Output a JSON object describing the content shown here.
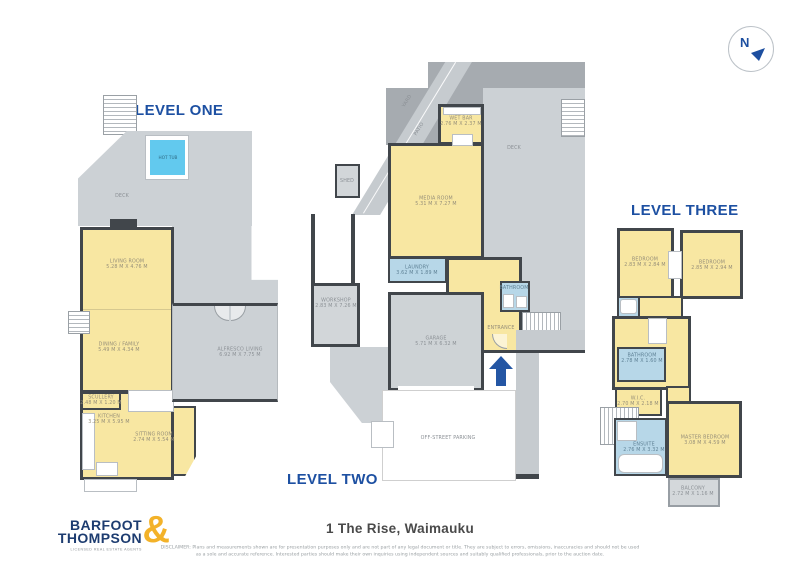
{
  "compass": {
    "label": "N"
  },
  "level_one": {
    "title": "LEVEL ONE",
    "rooms": {
      "hot_tub": {
        "name": "HOT TUB"
      },
      "deck": {
        "name": "DECK"
      },
      "living_room": {
        "name": "LIVING ROOM",
        "dims": "5.28 M X 4.76 M"
      },
      "dining_family": {
        "name": "DINING / FAMILY",
        "dims": "5.49 M X 4.34 M"
      },
      "alfresco_living": {
        "name": "ALFRESCO LIVING",
        "dims": "6.92 M X 7.75 M"
      },
      "scullery": {
        "name": "SCULLERY",
        "dims": "2.48 M X 1.20 M"
      },
      "kitchen": {
        "name": "KITCHEN",
        "dims": "3.25 M X 5.95 M"
      },
      "sitting_room": {
        "name": "SITTING ROOM",
        "dims": "2.74 M X 5.54 M"
      }
    }
  },
  "level_two": {
    "title": "LEVEL TWO",
    "rooms": {
      "yard": {
        "name": "YARD"
      },
      "patio": {
        "name": "PATIO"
      },
      "wet_bar": {
        "name": "WET BAR",
        "dims": "2.76 M X 2.37 M"
      },
      "deck": {
        "name": "DECK"
      },
      "shed": {
        "name": "SHED"
      },
      "media_room": {
        "name": "MEDIA ROOM",
        "dims": "5.31 M X 7.27 M"
      },
      "laundry": {
        "name": "LAUNDRY",
        "dims": "3.62 M X 1.89 M"
      },
      "bathroom": {
        "name": "BATHROOM"
      },
      "workshop": {
        "name": "WORKSHOP",
        "dims": "2.83 M X 7.26 M"
      },
      "garage": {
        "name": "GARAGE",
        "dims": "5.71 M X 6.32 M"
      },
      "entrance": {
        "name": "ENTRANCE"
      },
      "parking": {
        "name": "OFF-STREET PARKING"
      }
    }
  },
  "level_three": {
    "title": "LEVEL THREE",
    "rooms": {
      "bedroom_left": {
        "name": "BEDROOM",
        "dims": "2.83 M X 2.84 M"
      },
      "bedroom_right": {
        "name": "BEDROOM",
        "dims": "2.85 M X 2.94 M"
      },
      "bathroom": {
        "name": "BATHROOM",
        "dims": "2.78 M X 1.60 M"
      },
      "wic": {
        "name": "W.I.C.",
        "dims": "2.70 M X 2.18 M"
      },
      "ensuite": {
        "name": "ENSUITE",
        "dims": "2.76 M X 3.32 M"
      },
      "master_bedroom": {
        "name": "MASTER BEDROOM",
        "dims": "3.08 M X 4.59 M"
      },
      "balcony": {
        "name": "BALCONY",
        "dims": "2.72 M X 1.16 M"
      }
    }
  },
  "footer": {
    "address": "1 The Rise, Waimauku",
    "disclaimer_line1": "DISCLAIMER: Plans and measurements shown are for presentation purposes only and are not part of any legal document or title. They are subject to errors, omissions, inaccuracies and should not be used",
    "disclaimer_line2": "as a sole and accurate reference. Interested parties should make their own inquiries using independent sources and suitably qualified professionals, prior to the auction date."
  },
  "logo": {
    "word1": "BARFOOT",
    "word2": "THOMPSON",
    "ampersand": "&",
    "tagline": "LICENSED REAL ESTATE AGENTS"
  },
  "colors": {
    "accent_blue": "#1d50a2",
    "room_yellow": "#f8e7a2",
    "wet_room_blue": "#b7d7e8",
    "hot_tub_cyan": "#62c9ee",
    "deck_gray": "#ccd1d5",
    "wall_dark": "#41464b",
    "logo_navy": "#1d3c70",
    "logo_gold": "#f3b229",
    "arrow_blue": "#2456a4"
  }
}
